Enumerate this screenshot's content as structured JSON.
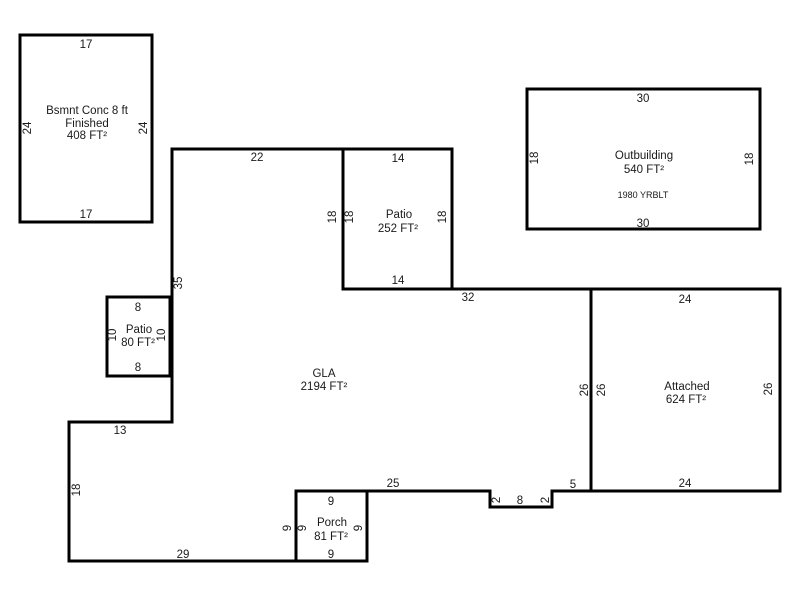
{
  "colors": {
    "background": "#ffffff",
    "wall": "#000000",
    "text": "#1a1a1a"
  },
  "areas": {
    "basement": {
      "line1": "Bsmnt Conc 8 ft",
      "line2": "Finished",
      "area": "408 FT²",
      "top": "17",
      "left": "24",
      "right": "24",
      "bottom": "17"
    },
    "outbuilding": {
      "name": "Outbuilding",
      "area": "540 FT²",
      "year": "1980 YRBLT",
      "top": "30",
      "left": "18",
      "right": "18",
      "bottom": "30"
    },
    "patio_large": {
      "name": "Patio",
      "area": "252 FT²",
      "top": "14",
      "left": "18",
      "right": "18",
      "bottom": "14"
    },
    "patio_small": {
      "name": "Patio",
      "area": "80 FT²",
      "top": "8",
      "left": "10",
      "right": "10",
      "bottom": "8"
    },
    "porch": {
      "name": "Porch",
      "area": "81 FT²",
      "top": "9",
      "left": "9",
      "right": "9",
      "bottom": "9"
    },
    "attached": {
      "name": "Attached",
      "area": "624 FT²",
      "top": "24",
      "left": "26",
      "right": "26",
      "bottom": "24"
    },
    "gla": {
      "name": "GLA",
      "area": "2194 FT²",
      "top": "22",
      "left": "35",
      "patio_wall": "18",
      "upper_right": "32",
      "attached_wall": "26",
      "right_of_notch": "5",
      "notch_left": "2",
      "notch_bottom": "8",
      "notch_right": "2",
      "bottom_right": "25",
      "porch_wall": "9",
      "bottom": "29",
      "lower_left": "18",
      "step": "13"
    }
  }
}
